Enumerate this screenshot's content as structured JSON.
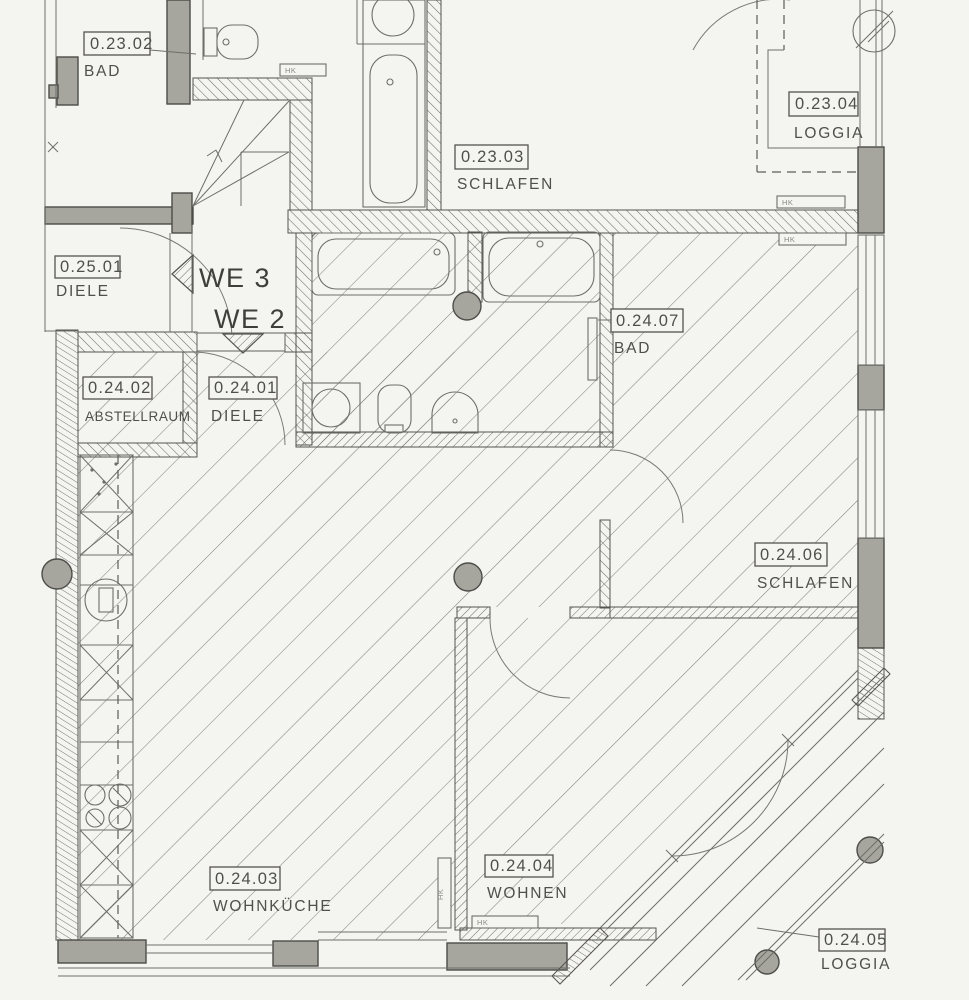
{
  "plan": {
    "title": "Grundriss Erdgeschoss WE 2",
    "rooms": [
      {
        "id": "0.23.02",
        "name": "BAD"
      },
      {
        "id": "0.23.03",
        "name": "SCHLAFEN"
      },
      {
        "id": "0.23.04",
        "name": "LOGGIA"
      },
      {
        "id": "0.25.01",
        "name": "DIELE"
      },
      {
        "id": "0.24.02",
        "name": "ABSTELLRAUM"
      },
      {
        "id": "0.24.01",
        "name": "DIELE"
      },
      {
        "id": "0.24.07",
        "name": "BAD"
      },
      {
        "id": "0.24.06",
        "name": "SCHLAFEN"
      },
      {
        "id": "0.24.03",
        "name": "WOHNKÜCHE"
      },
      {
        "id": "0.24.04",
        "name": "WOHNEN"
      },
      {
        "id": "0.24.05",
        "name": "LOGGIA"
      }
    ],
    "units": {
      "we3": "WE 3",
      "we2": "WE 2"
    },
    "radiator_label": "HK",
    "colors": {
      "background": "#f4f4f1",
      "line": "#4f4f4b",
      "wall_fill": "#a6a69f",
      "floor_hatch": "#85857f"
    }
  }
}
